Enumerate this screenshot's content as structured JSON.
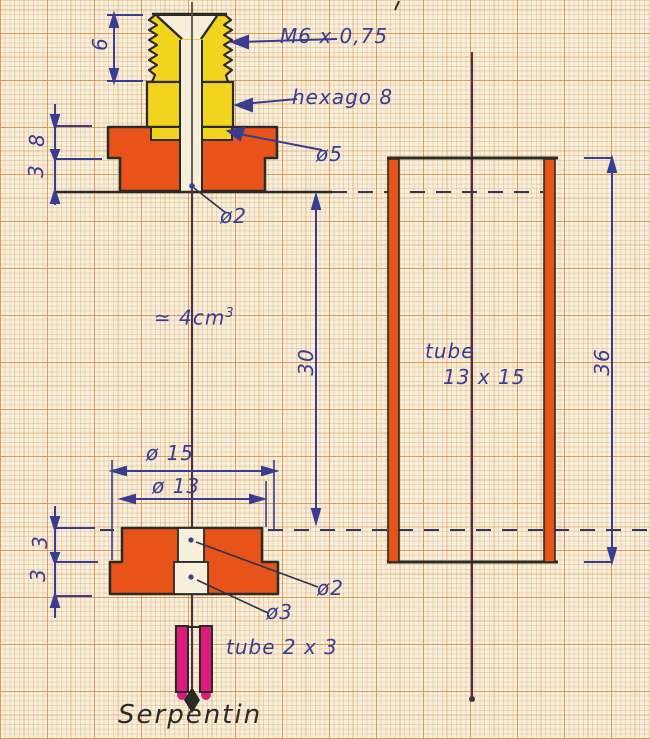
{
  "drawing_type": "hand-drawn technical sketch on millimeter graph paper",
  "top_view": {
    "dim_thread_height": "6",
    "thread_spec": "M6 x 0,75",
    "hex_label": "hexago 8",
    "phi5": "ø5",
    "dim_8": "8",
    "dim_3": "3",
    "phi2": "ø2"
  },
  "middle": {
    "volume": "≃ 4cm",
    "volume_exp": "3",
    "dim_30": "30"
  },
  "tube_view": {
    "line1": "tube",
    "line2": "13 x 15",
    "dim_36": "36"
  },
  "bottom_view": {
    "phi15": "ø 15",
    "phi13": "ø 13",
    "dim_3_upper": "3",
    "dim_3_lower": "3",
    "phi2": "ø2",
    "phi3": "ø3",
    "tube_small_label": "tube 2 x 3",
    "serpentin": "Serpentin"
  },
  "colors": {
    "paper": "#f8efdb",
    "grid_orange": "#d07a2e",
    "part_orange": "#e8531a",
    "part_yellow": "#f2d41f",
    "part_magenta": "#dc1a7c",
    "ink_blue": "#383d91",
    "ink_black": "#2b2b26",
    "centerline_maroon": "#4b2f45"
  }
}
